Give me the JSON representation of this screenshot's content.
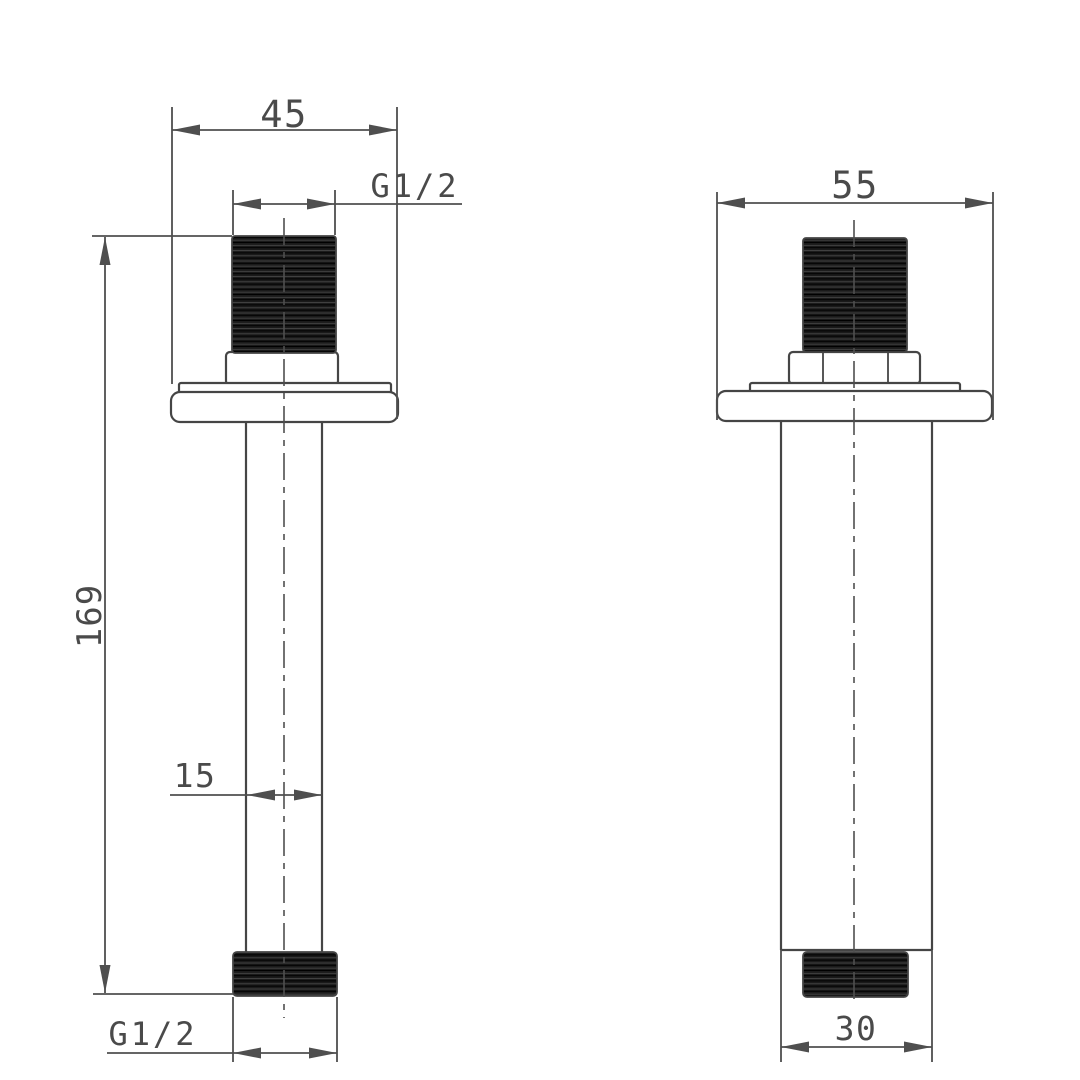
{
  "drawing": {
    "kind": "technical-dimension-drawing",
    "views": {
      "left": {
        "dimensions": {
          "flange_width": "45",
          "top_thread": "G1/2",
          "overall_height": "169",
          "pipe_diameter": "15",
          "bottom_thread": "G1/2"
        }
      },
      "right": {
        "dimensions": {
          "flange_width": "55",
          "pipe_diameter": "30"
        }
      }
    }
  },
  "colors": {
    "background": "#ffffff",
    "line": "#454545",
    "dim_line": "#4f4f4f",
    "text": "#4a4a4a",
    "thread_dark": "#1a1a1a",
    "thread_stripe": "#454545"
  }
}
